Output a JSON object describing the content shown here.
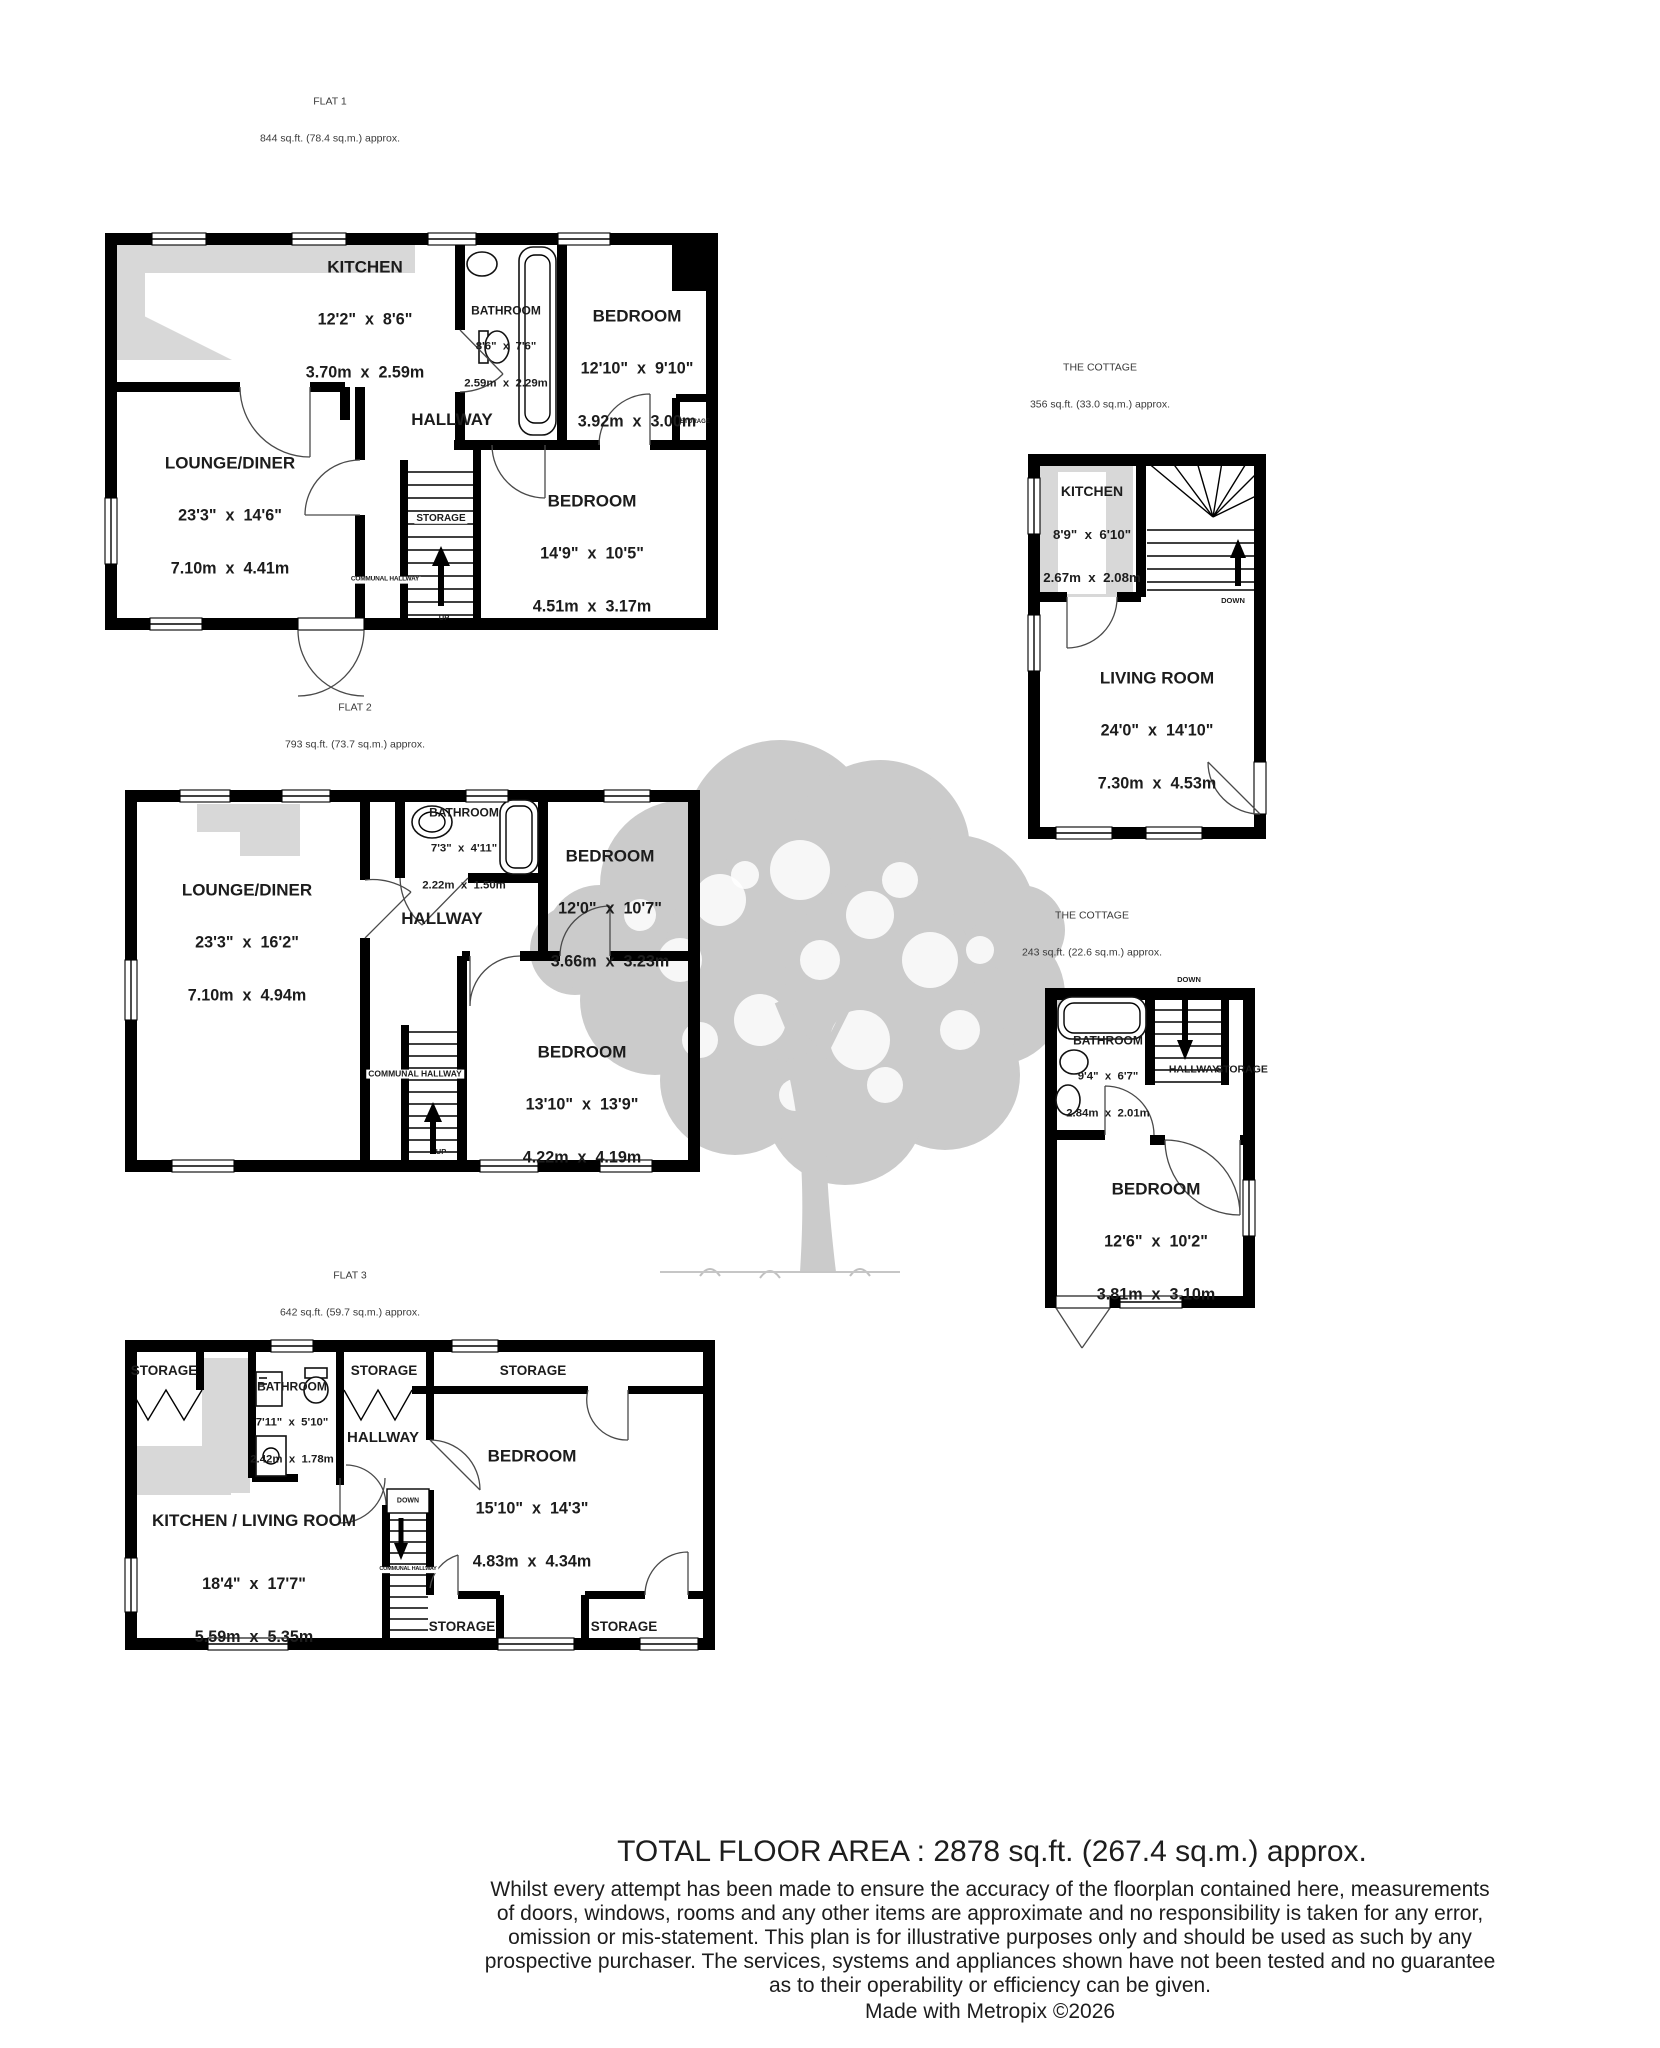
{
  "colors": {
    "wall": "#000000",
    "counter_gray": "#d8d8d8",
    "tree_gray": "#cbcbcb"
  },
  "flat1": {
    "title": "FLAT 1",
    "area": "844 sq.ft. (78.4 sq.m.) approx.",
    "kitchen": {
      "name": "KITCHEN",
      "imp": "12'2\"  x  8'6\"",
      "met": "3.70m  x  2.59m"
    },
    "bathroom": {
      "name": "BATHROOM",
      "imp": "8'6\"  x  7'6\"",
      "met": "2.59m  x  2.29m"
    },
    "bedroom1": {
      "name": "BEDROOM",
      "imp": "12'10\"  x  9'10\"",
      "met": "3.92m  x  3.00m"
    },
    "lounge": {
      "name": "LOUNGE/DINER",
      "imp": "23'3\"  x  14'6\"",
      "met": "7.10m  x  4.41m"
    },
    "bedroom2": {
      "name": "BEDROOM",
      "imp": "14'9\"  x  10'5\"",
      "met": "4.51m  x  3.17m"
    },
    "hallway": "HALLWAY",
    "storage_stairs": "STORAGE",
    "storage_small": "STORAGE",
    "communal": "COMMUNAL HALLWAY",
    "up": "UP"
  },
  "cottage_ground": {
    "title": "THE COTTAGE",
    "area": "356 sq.ft. (33.0 sq.m.) approx.",
    "kitchen": {
      "name": "KITCHEN",
      "imp": "8'9\"  x  6'10\"",
      "met": "2.67m  x  2.08m"
    },
    "living": {
      "name": "LIVING ROOM",
      "imp": "24'0\"  x  14'10\"",
      "met": "7.30m  x  4.53m"
    },
    "down": "DOWN"
  },
  "flat2": {
    "title": "FLAT 2",
    "area": "793 sq.ft. (73.7 sq.m.) approx.",
    "bathroom": {
      "name": "BATHROOM",
      "imp": "7'3\"  x  4'11\"",
      "met": "2.22m  x  1.50m"
    },
    "bedroom1": {
      "name": "BEDROOM",
      "imp": "12'0\"  x  10'7\"",
      "met": "3.66m  x  3.23m"
    },
    "lounge": {
      "name": "LOUNGE/DINER",
      "imp": "23'3\"  x  16'2\"",
      "met": "7.10m  x  4.94m"
    },
    "bedroom2": {
      "name": "BEDROOM",
      "imp": "13'10\"  x  13'9\"",
      "met": "4.22m  x  4.19m"
    },
    "hallway": "HALLWAY",
    "communal": "COMMUNAL HALLWAY",
    "up": "UP"
  },
  "cottage_first": {
    "title": "THE COTTAGE",
    "area": "243 sq.ft. (22.6 sq.m.) approx.",
    "bathroom": {
      "name": "BATHROOM",
      "imp": "9'4\"  x  6'7\"",
      "met": "2.84m  x  2.01m"
    },
    "bedroom": {
      "name": "BEDROOM",
      "imp": "12'6\"  x  10'2\"",
      "met": "3.81m  x  3.10m"
    },
    "hallway": "HALLWAY",
    "storage": "STORAGE",
    "down": "DOWN"
  },
  "flat3": {
    "title": "FLAT 3",
    "area": "642 sq.ft. (59.7 sq.m.) approx.",
    "bathroom": {
      "name": "BATHROOM",
      "imp": "7'11\"  x  5'10\"",
      "met": "2.42m  x  1.78m"
    },
    "bedroom": {
      "name": "BEDROOM",
      "imp": "15'10\"  x  14'3\"",
      "met": "4.83m  x  4.34m"
    },
    "kitchen_living": {
      "name": "KITCHEN / LIVING ROOM",
      "imp": "18'4\"  x  17'7\"",
      "met": "5.59m  x  5.35m"
    },
    "storage_tl": "STORAGE",
    "storage_tm": "STORAGE",
    "storage_tr": "STORAGE",
    "storage_bm": "STORAGE",
    "storage_br": "STORAGE",
    "hallway": "HALLWAY",
    "communal": "COMMUNAL HALLWAY",
    "down": "DOWN"
  },
  "footer": {
    "total": "TOTAL FLOOR AREA : 2878 sq.ft. (267.4 sq.m.) approx.",
    "line1": "Whilst every attempt has been made to ensure the accuracy of the floorplan contained here, measurements",
    "line2": "of doors, windows, rooms and any other items are approximate and no responsibility is taken for any error,",
    "line3": "omission or mis-statement. This plan is for illustrative purposes only and should be used as such by any",
    "line4": "prospective purchaser. The services, systems and appliances shown have not been tested and no guarantee",
    "line5": "as to their operability or efficiency can be given.",
    "credit": "Made with Metropix ©2026"
  }
}
